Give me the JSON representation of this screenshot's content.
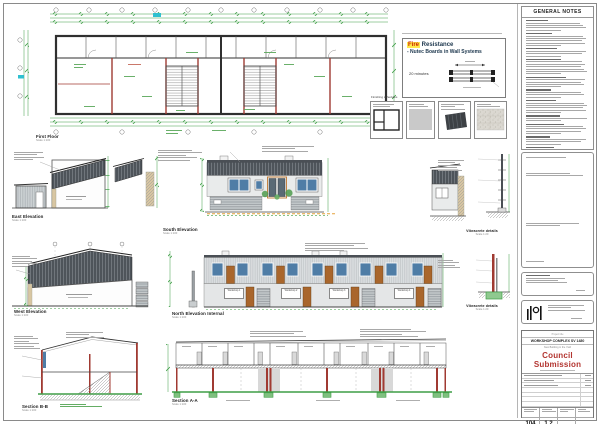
{
  "sheet": {
    "type": "architectural-drawing-sheet"
  },
  "labels": {
    "first_floor": {
      "title": "First Floor",
      "scale": "Scale 1:100"
    },
    "east": {
      "title": "East Elevation",
      "scale": "Scale 1:100"
    },
    "south": {
      "title": "South Elevation",
      "scale": "Scale 1:100"
    },
    "west": {
      "title": "West Elevation",
      "scale": "Scale 1:100"
    },
    "north": {
      "title": "North Elevation Internal",
      "scale": "Scale 1:100"
    },
    "section_bb": {
      "title": "Section B-B",
      "scale": "Scale 1:100"
    },
    "section_aa": {
      "title": "Section A-A",
      "scale": "Scale 1:100"
    },
    "vibracrete_1": {
      "title": "Vibracrete details",
      "scale": "Scale 1:20"
    },
    "vibracrete_2": {
      "title": "Vibracrete details",
      "scale": "Scale 1:20"
    }
  },
  "fire_note": {
    "highlight": "Fire",
    "title_rest": " Resistance",
    "line2": "- Nutec Boards in Wall Systems",
    "duration": "20 minutes"
  },
  "finishing": {
    "heading": "Finishing schedules",
    "panels": [
      {
        "name": "window-schedule-diagram"
      },
      {
        "name": "plaster-finish-swatch"
      },
      {
        "name": "roof-sheeting-sample"
      },
      {
        "name": "wall-texture-swatch"
      }
    ]
  },
  "general_notes": {
    "title": "GENERAL NOTES"
  },
  "north_units": {
    "u1": "Workshop 1",
    "u2": "Workshop 2",
    "u3": "Workshop 3",
    "u4": "Workshop 4"
  },
  "title_block": {
    "project_label": "Project title",
    "project_title": "WORKSHOP COMPLEX SV 1480",
    "project_subtitle": "New Building in the Yard",
    "status": "Council Submission",
    "sheet_no": "104",
    "revision": "1.2"
  },
  "colors": {
    "dimension_green": "#3f9e46",
    "accent_wall_red": "#a03a32",
    "window_blue": "#4f7da6",
    "door_brown": "#a9662c",
    "cladding_dark": "#4a4f55",
    "highlight_cyan": "#2fc0d0",
    "council_red": "#b33530",
    "fire_red": "#cc2200",
    "fire_highlight_yellow": "#ffe94d",
    "ground_orange": "#e6a23c"
  }
}
